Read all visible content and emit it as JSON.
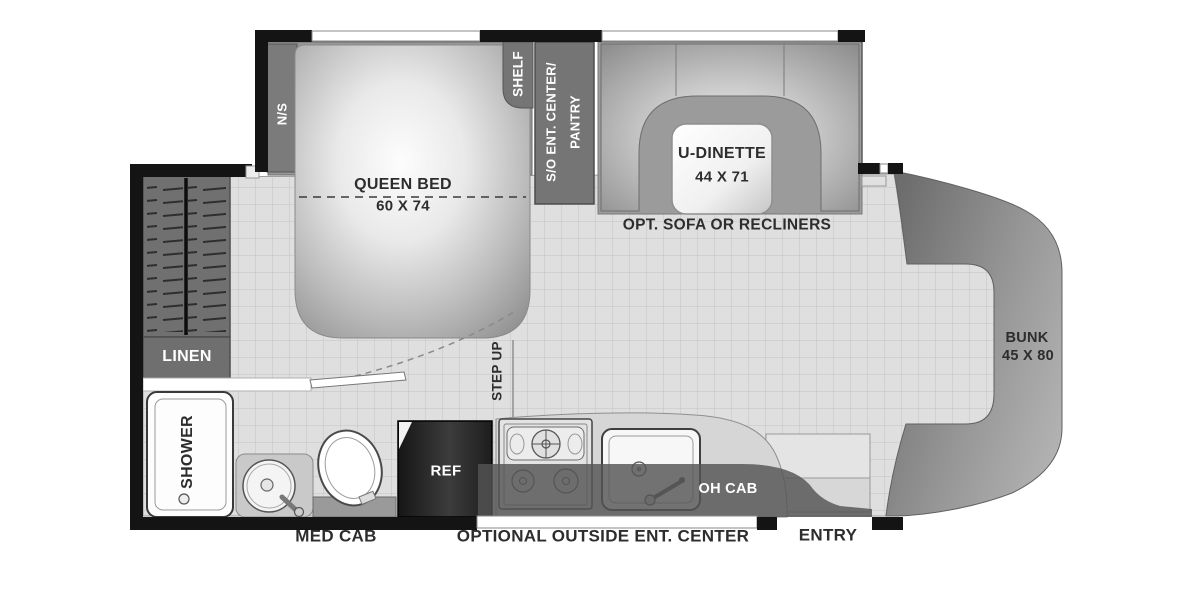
{
  "plan_type": "rv-floorplan",
  "labels": {
    "queen_bed": "QUEEN BED",
    "queen_bed_size": "60 X 74",
    "nightstand": "N/S",
    "shelf": "SHELF",
    "pantry_1": "S/O ENT. CENTER/",
    "pantry_2": "PANTRY",
    "dinette": "U-DINETTE",
    "dinette_size": "44 X 71",
    "sofa_option": "OPT. SOFA OR RECLINERS",
    "bunk": "BUNK",
    "bunk_size": "45 X 80",
    "step_up": "STEP UP",
    "linen": "LINEN",
    "shower": "SHOWER",
    "ref": "REF",
    "oh_cab": "OH CAB",
    "med_cab": "MED CAB",
    "outside_ent": "OPTIONAL OUTSIDE ENT. CENTER",
    "entry": "ENTRY"
  },
  "colors": {
    "wall": "#141414",
    "floor": "#dfdfdf",
    "grid": "#c3c3c3",
    "cabinet": "#717171",
    "slide_interior": "#979797",
    "cab_front": "#8f8f8f",
    "label_dark": "#2d2d2d",
    "label_light": "#ffffff"
  }
}
